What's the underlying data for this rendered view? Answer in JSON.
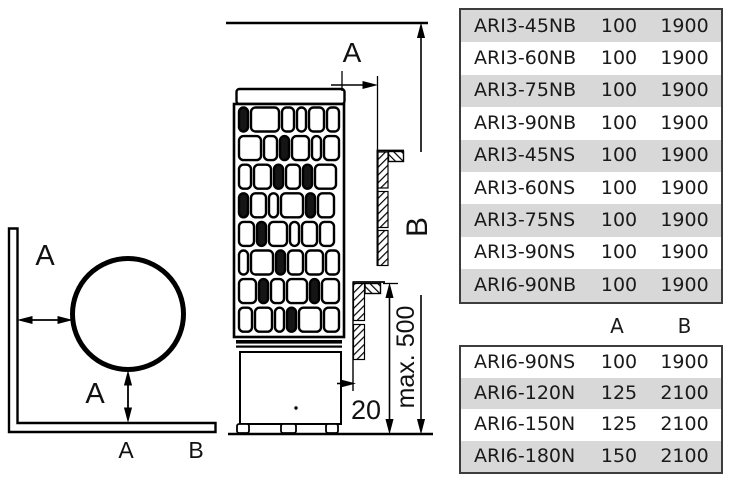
{
  "figure": {
    "top_view": {
      "label_a_wall": "A",
      "label_a_floor": "A",
      "axis_a": "A",
      "axis_b": "B"
    },
    "front_view": {
      "label_a": "A",
      "label_b": "B",
      "label_max_height": "max. 500",
      "label_gap": "20"
    }
  },
  "columns": {
    "a": "A",
    "b": "B"
  },
  "table1": {
    "rows": [
      {
        "model": "ARI3-45NB",
        "a": "100",
        "b": "1900"
      },
      {
        "model": "ARI3-60NB",
        "a": "100",
        "b": "1900"
      },
      {
        "model": "ARI3-75NB",
        "a": "100",
        "b": "1900"
      },
      {
        "model": "ARI3-90NB",
        "a": "100",
        "b": "1900"
      },
      {
        "model": "ARI3-45NS",
        "a": "100",
        "b": "1900"
      },
      {
        "model": "ARI3-60NS",
        "a": "100",
        "b": "1900"
      },
      {
        "model": "ARI3-75NS",
        "a": "100",
        "b": "1900"
      },
      {
        "model": "ARI3-90NS",
        "a": "100",
        "b": "1900"
      },
      {
        "model": "ARI6-90NB",
        "a": "100",
        "b": "1900"
      }
    ]
  },
  "table2": {
    "rows": [
      {
        "model": "ARI6-90NS",
        "a": "100",
        "b": "1900"
      },
      {
        "model": "ARI6-120N",
        "a": "125",
        "b": "2100"
      },
      {
        "model": "ARI6-150N",
        "a": "125",
        "b": "2100"
      },
      {
        "model": "ARI6-180N",
        "a": "150",
        "b": "2100"
      }
    ]
  },
  "colors": {
    "row_shade": "#d8d8d8",
    "table_border": "#3d3d3d",
    "ink": "#1a1a1a"
  }
}
